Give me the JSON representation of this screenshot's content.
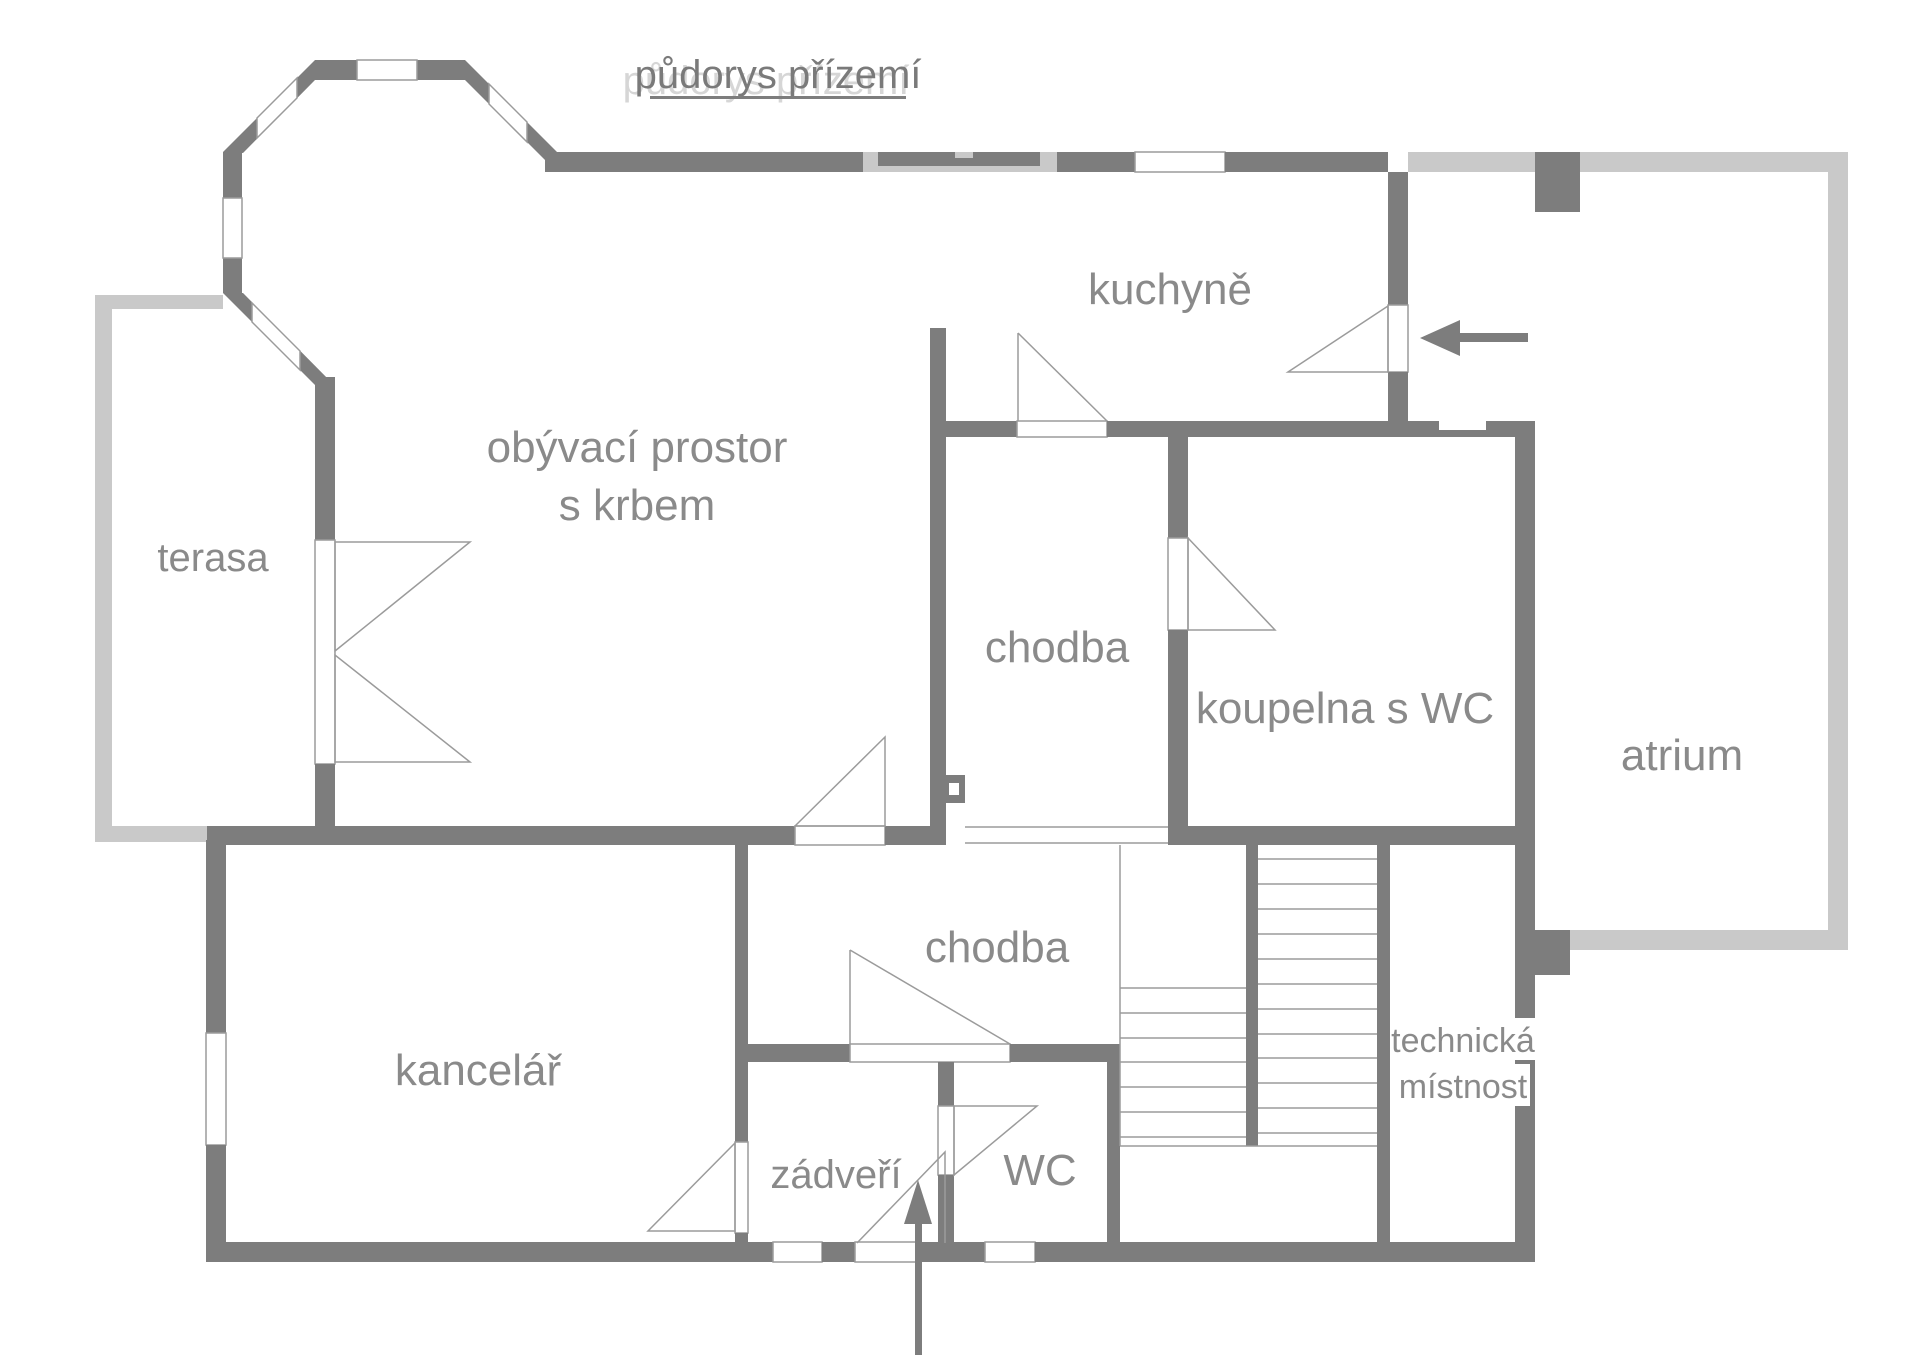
{
  "title": {
    "text": "půdorys přízemí"
  },
  "colors": {
    "wall": "#7d7d7d",
    "outline_light": "#c9c9c9",
    "thin_line": "#9b9b9b",
    "label_text": "#8a8a8a",
    "title_text": "#7a7a7a"
  },
  "rooms": {
    "terasa": {
      "label": "terasa"
    },
    "obyvaci": {
      "label_line1": "obývací prostor",
      "label_line2": "s krbem"
    },
    "kuchyne": {
      "label": "kuchyně"
    },
    "chodba_upper": {
      "label": "chodba"
    },
    "koupelna": {
      "label": "koupelna s WC"
    },
    "atrium": {
      "label": "atrium"
    },
    "chodba_lower": {
      "label": "chodba"
    },
    "kancelar": {
      "label": "kancelář"
    },
    "technicka": {
      "label_line1": "technická",
      "label_line2": "místnost"
    },
    "zadveri": {
      "label": "zádveří"
    },
    "wc": {
      "label": "WC"
    }
  },
  "icons": {
    "side_entrance_arrow": "arrow-left-into-kitchen",
    "main_entrance_arrow": "arrow-up-into-zadveri"
  }
}
